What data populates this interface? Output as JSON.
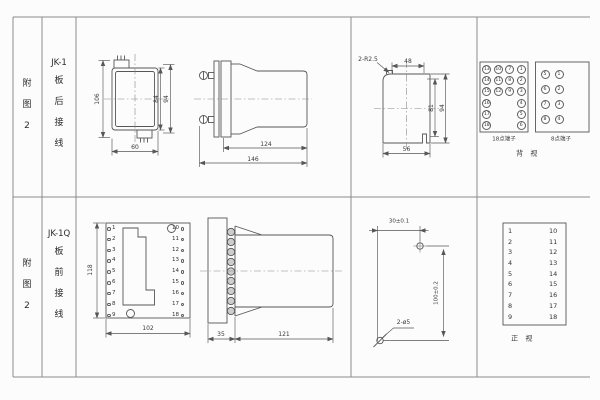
{
  "header": {
    "row1": {
      "fig": "附图2",
      "model": "JK-1",
      "wiring": "板后接线"
    },
    "row2": {
      "fig": "附图2",
      "model": "JK-1Q",
      "wiring": "板前接线"
    }
  },
  "jk1_rear": {
    "front_view": {
      "total_height": "106",
      "body_height": "84",
      "flange_height": "94",
      "width": "60"
    },
    "side_view": {
      "body_length": "124",
      "total_length": "146"
    },
    "panel_cutout": {
      "corner_radius": "2-R2.5",
      "top_width": "48",
      "inner_height": "81",
      "outer_height": "94",
      "bottom_width": "56"
    },
    "terminal_view": {
      "t18_label": "18点端子",
      "t18_numbers": [
        "13",
        "10",
        "7",
        "1",
        "14",
        "11",
        "8",
        "2",
        "15",
        "12",
        "9",
        "3",
        "16",
        "",
        "",
        "4",
        "17",
        "",
        "",
        "5",
        "18",
        "",
        "",
        "6"
      ],
      "t8_label": "8点端子",
      "t8_numbers": [
        "5",
        "1",
        "6",
        "2",
        "7",
        "3",
        "8",
        "4"
      ],
      "caption": "背 视"
    }
  },
  "jk1q_front": {
    "front_view": {
      "height": "118",
      "width": "102",
      "left_terminals": [
        "1",
        "2",
        "3",
        "4",
        "5",
        "6",
        "7",
        "8",
        "9"
      ],
      "right_terminals": [
        "10",
        "11",
        "12",
        "13",
        "14",
        "15",
        "16",
        "17",
        "18"
      ]
    },
    "side_view": {
      "flange_depth": "35",
      "body_length": "121"
    },
    "drill_plan": {
      "hole_pitch_x": "30±0.1",
      "hole_pitch_y": "100±0.2",
      "hole_spec": "2-ø5"
    },
    "terminal_view": {
      "left": [
        "1",
        "2",
        "3",
        "4",
        "5",
        "6",
        "7",
        "8",
        "9"
      ],
      "right": [
        "10",
        "11",
        "12",
        "13",
        "14",
        "15",
        "16",
        "17",
        "18"
      ],
      "caption": "正 视"
    }
  }
}
